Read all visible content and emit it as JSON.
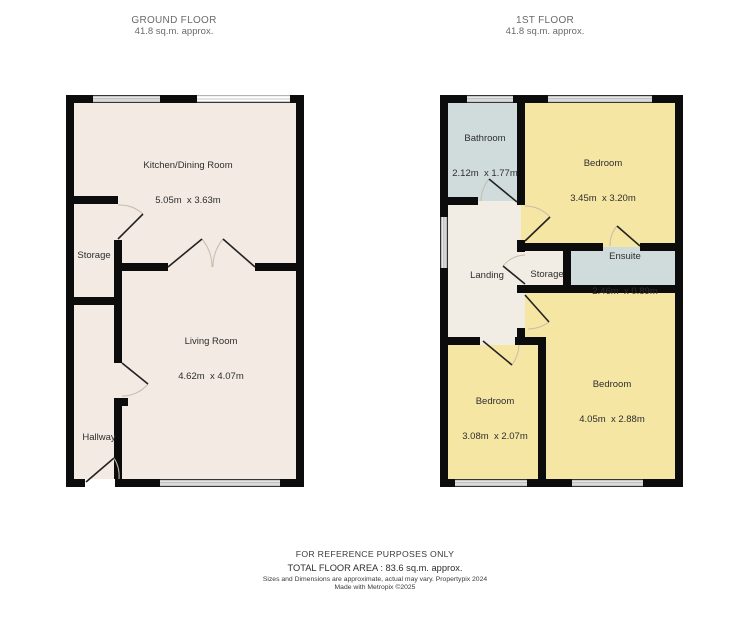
{
  "ground_floor": {
    "title": "GROUND FLOOR",
    "area": "41.8 sq.m. approx.",
    "rooms": [
      {
        "name": "Kitchen/Dining Room",
        "dims": "5.05m  x 3.63m"
      },
      {
        "name": "Storage"
      },
      {
        "name": "Living Room",
        "dims": "4.62m  x 4.07m"
      },
      {
        "name": "Hallway"
      }
    ]
  },
  "first_floor": {
    "title": "1ST FLOOR",
    "area": "41.8 sq.m. approx.",
    "rooms": [
      {
        "name": "Bathroom",
        "dims": "2.12m  x 1.77m"
      },
      {
        "name": "Bedroom",
        "dims": "3.45m  x 3.20m"
      },
      {
        "name": "Landing"
      },
      {
        "name": "Storage"
      },
      {
        "name": "Ensuite",
        "dims": "2.46m  x 0.89m"
      },
      {
        "name": "Bedroom",
        "dims": "3.08m  x 2.07m"
      },
      {
        "name": "Bedroom",
        "dims": "4.05m  x 2.88m"
      }
    ]
  },
  "footer": {
    "reference": "FOR REFERENCE PURPOSES ONLY",
    "total_area": "TOTAL FLOOR AREA : 83.6 sq.m. approx.",
    "disclaimer": "Sizes and Dimensions are approximate, actual may vary. Propertypix 2024",
    "made_with": "Made with Metropix ©2025"
  },
  "colors": {
    "wall": "#0c0c0c",
    "ground_floor_room_fill": "#f2eae3",
    "bedroom_fill": "#f5e6a4",
    "bathroom_fill": "#cfdcdb",
    "landing_fill": "#f1ece4",
    "door_arc": "#c7bcab"
  }
}
